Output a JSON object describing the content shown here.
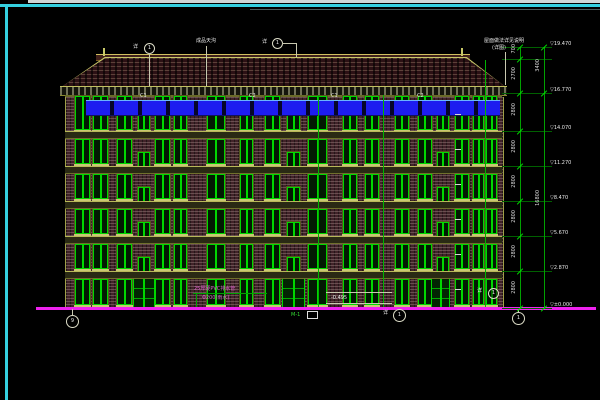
{
  "drawing_type": "building-elevation-cad",
  "colors": {
    "frame_cyan": "#35d0e0",
    "ground_magenta": "#ee22ee",
    "window_green": "#00d800",
    "rail_blue": "#1d1df0",
    "wall_maroon": "#412329",
    "trim_olive": "#b8b858"
  },
  "ann": {
    "gutter_note": "成品天沟",
    "ridge_callout_label": "1",
    "ridge_callout_side": "详",
    "left_callout_label": "1",
    "left_callout_side": "详",
    "roof_note_1": "屋面做法详见说明",
    "roof_note_2": "(详图)",
    "pvc_note_1": "25厚硬PVC排水管",
    "pvc_note_2": "Φ200(雨水)",
    "ground_note": "-0.495",
    "door_note": "M-1",
    "mid_callout_label": "1",
    "mid_callout_side": "详",
    "eave_callout_label": "1",
    "eave_callout_side": "详",
    "axis_left": "9",
    "axis_right": "1"
  },
  "facade": {
    "left": 65,
    "width": 437,
    "ground_y": 308,
    "floors": [
      {
        "name": "6F",
        "win_y": 96,
        "win_h": 33
      },
      {
        "name": "5F",
        "win_y": 139,
        "win_h": 23
      },
      {
        "name": "4F",
        "win_y": 174,
        "win_h": 23
      },
      {
        "name": "3F",
        "win_y": 209,
        "win_h": 23
      },
      {
        "name": "2F",
        "win_y": 244,
        "win_h": 23
      },
      {
        "name": "1F",
        "win_y": 279,
        "win_h": 24
      }
    ],
    "slab_ys": [
      131,
      166,
      201,
      236,
      271
    ],
    "columns": [
      {
        "x": 75,
        "w": 13,
        "type": "win"
      },
      {
        "x": 93,
        "w": 13,
        "type": "win"
      },
      {
        "x": 117,
        "w": 13,
        "type": "win"
      },
      {
        "x": 138,
        "w": 10,
        "type": "stair"
      },
      {
        "x": 155,
        "w": 13,
        "type": "win"
      },
      {
        "x": 174,
        "w": 11,
        "type": "win"
      },
      {
        "x": 207,
        "w": 16,
        "type": "win"
      },
      {
        "x": 240,
        "w": 11,
        "type": "win"
      },
      {
        "x": 265,
        "w": 13,
        "type": "win"
      },
      {
        "x": 287,
        "w": 11,
        "type": "stair"
      },
      {
        "x": 308,
        "w": 17,
        "type": "win"
      },
      {
        "x": 343,
        "w": 12,
        "type": "win"
      },
      {
        "x": 365,
        "w": 12,
        "type": "win"
      },
      {
        "x": 395,
        "w": 12,
        "type": "win"
      },
      {
        "x": 418,
        "w": 12,
        "type": "win"
      },
      {
        "x": 437,
        "w": 10,
        "type": "stair"
      },
      {
        "x": 455,
        "w": 12,
        "type": "win"
      },
      {
        "x": 473,
        "w": 9,
        "type": "win"
      },
      {
        "x": 486,
        "w": 9,
        "type": "win"
      }
    ],
    "doors": [
      {
        "x": 133,
        "w": 20
      },
      {
        "x": 282,
        "w": 21
      },
      {
        "x": 431,
        "w": 17
      }
    ],
    "downspouts": [
      {
        "x": 318,
        "y1": 95,
        "y2": 307
      },
      {
        "x": 383,
        "y1": 95,
        "y2": 307
      },
      {
        "x": 485,
        "y1": 60,
        "y2": 307
      }
    ],
    "window_type_labels": [
      {
        "x": 140,
        "text": "C1"
      },
      {
        "x": 249,
        "text": "C2"
      },
      {
        "x": 331,
        "text": "C1"
      },
      {
        "x": 417,
        "text": "C2"
      }
    ],
    "landing_mark_ys": [
      114,
      149,
      184,
      219,
      254,
      289
    ]
  },
  "dim_ladder": {
    "line1_x": 520,
    "line2_x": 544,
    "ext_x1": 502,
    "ext_x2": 552,
    "top_y": 47,
    "bottom_y": 308,
    "tick_ys": [
      47,
      59,
      93,
      131,
      166,
      201,
      236,
      271,
      308
    ],
    "line2_tick_ys": [
      47,
      93,
      308
    ],
    "segment_dims": [
      "700",
      "2700",
      "2800",
      "2800",
      "2800",
      "2800",
      "2800",
      "2800"
    ],
    "total_dims": [
      {
        "y1": 47,
        "y2": 93,
        "v": "3400"
      },
      {
        "y1": 93,
        "y2": 308,
        "v": "16800"
      }
    ],
    "levels": [
      {
        "y": 47,
        "v": "19.470"
      },
      {
        "y": 93,
        "v": "16.770"
      },
      {
        "y": 131,
        "v": "14.070"
      },
      {
        "y": 166,
        "v": "11.270"
      },
      {
        "y": 201,
        "v": "8.470"
      },
      {
        "y": 236,
        "v": "5.670"
      },
      {
        "y": 271,
        "v": "2.870"
      },
      {
        "y": 308,
        "v": "±0.000"
      }
    ]
  }
}
